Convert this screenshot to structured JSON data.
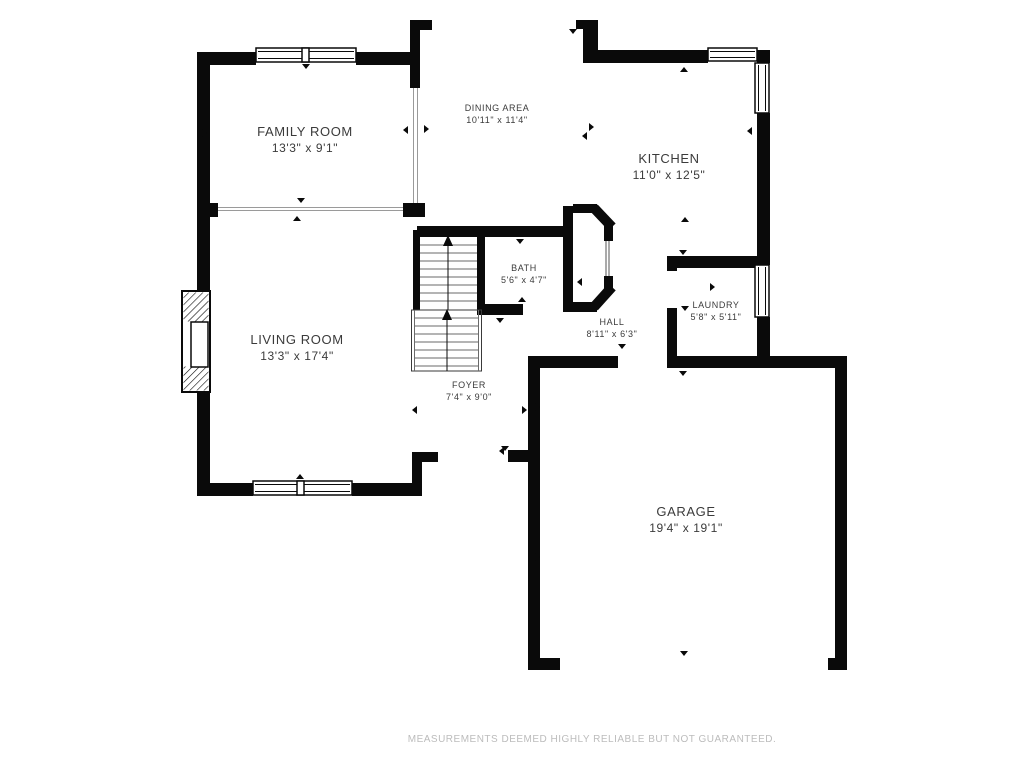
{
  "floorplan": {
    "disclaimer": "MEASUREMENTS DEEMED HIGHLY RELIABLE BUT NOT GUARANTEED.",
    "rooms": [
      {
        "id": "family-room",
        "name": "FAMILY ROOM",
        "dims": "13'3\" x 9'1\""
      },
      {
        "id": "dining-area",
        "name": "DINING AREA",
        "dims": "10'11\" x 11'4\""
      },
      {
        "id": "kitchen",
        "name": "KITCHEN",
        "dims": "11'0\" x 12'5\""
      },
      {
        "id": "living-room",
        "name": "LIVING ROOM",
        "dims": "13'3\" x 17'4\""
      },
      {
        "id": "bath",
        "name": "BATH",
        "dims": "5'6\" x 4'7\""
      },
      {
        "id": "hall",
        "name": "HALL",
        "dims": "8'11\" x 6'3\""
      },
      {
        "id": "laundry",
        "name": "LAUNDRY",
        "dims": "5'8\" x 5'11\""
      },
      {
        "id": "foyer",
        "name": "FOYER",
        "dims": "7'4\" x 9'0\""
      },
      {
        "id": "garage",
        "name": "GARAGE",
        "dims": "19'4\" x 19'1\""
      }
    ],
    "colors": {
      "wall": "#0a0a0a",
      "label_text": "#3b3b3b",
      "disclaimer_text": "#bcbcbc",
      "background": "#ffffff"
    }
  }
}
